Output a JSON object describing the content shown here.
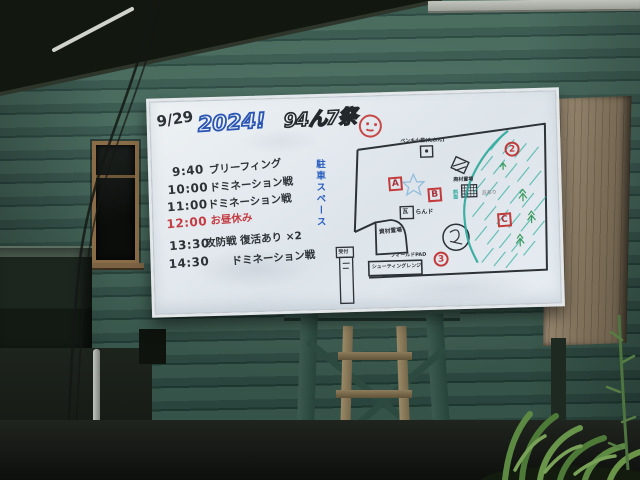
{
  "whiteboard": {
    "date": "9/29",
    "year": "2024!",
    "event_title": "94ん7祭",
    "smiley_icon": "red-smiley-face",
    "schedule": [
      {
        "time": "9:40",
        "label": "ブリーフィング"
      },
      {
        "time": "10:00",
        "label": "ドミネーション戦"
      },
      {
        "time": "11:00",
        "label": "ドミネーション戦"
      },
      {
        "time": "12:00",
        "label": "お昼休み",
        "color": "#c43c44"
      },
      {
        "time": "13:30",
        "label": "攻防戦 復活あり ×2"
      },
      {
        "time": "14:30",
        "label": "ドミネーション戦"
      }
    ],
    "parking_note": "駐車スペース",
    "map": {
      "zone_a": "A",
      "zone_b": "B",
      "zone_c": "C",
      "point_2": "2",
      "point_3": "3",
      "paint_hut_label": "ペンキ小屋(たぶん)",
      "tile_box": "瓦",
      "tile_suffix": "らんド",
      "scrap_label": "廃材置場",
      "materials_label": "資材置場",
      "field_pad_label": "フィールドPAD",
      "shooting_range_label": "シューティングレンジ",
      "reception_label": "受付",
      "hill_label": "丘あり",
      "slope_label": "斜面"
    }
  },
  "colors": {
    "marker_black": "#2d3237",
    "marker_red": "#c43c44",
    "marker_blue": "#2a5fc0",
    "marker_teal": "#2aa89a",
    "wall_green": "#35564b",
    "board_white": "#eaeff3"
  }
}
